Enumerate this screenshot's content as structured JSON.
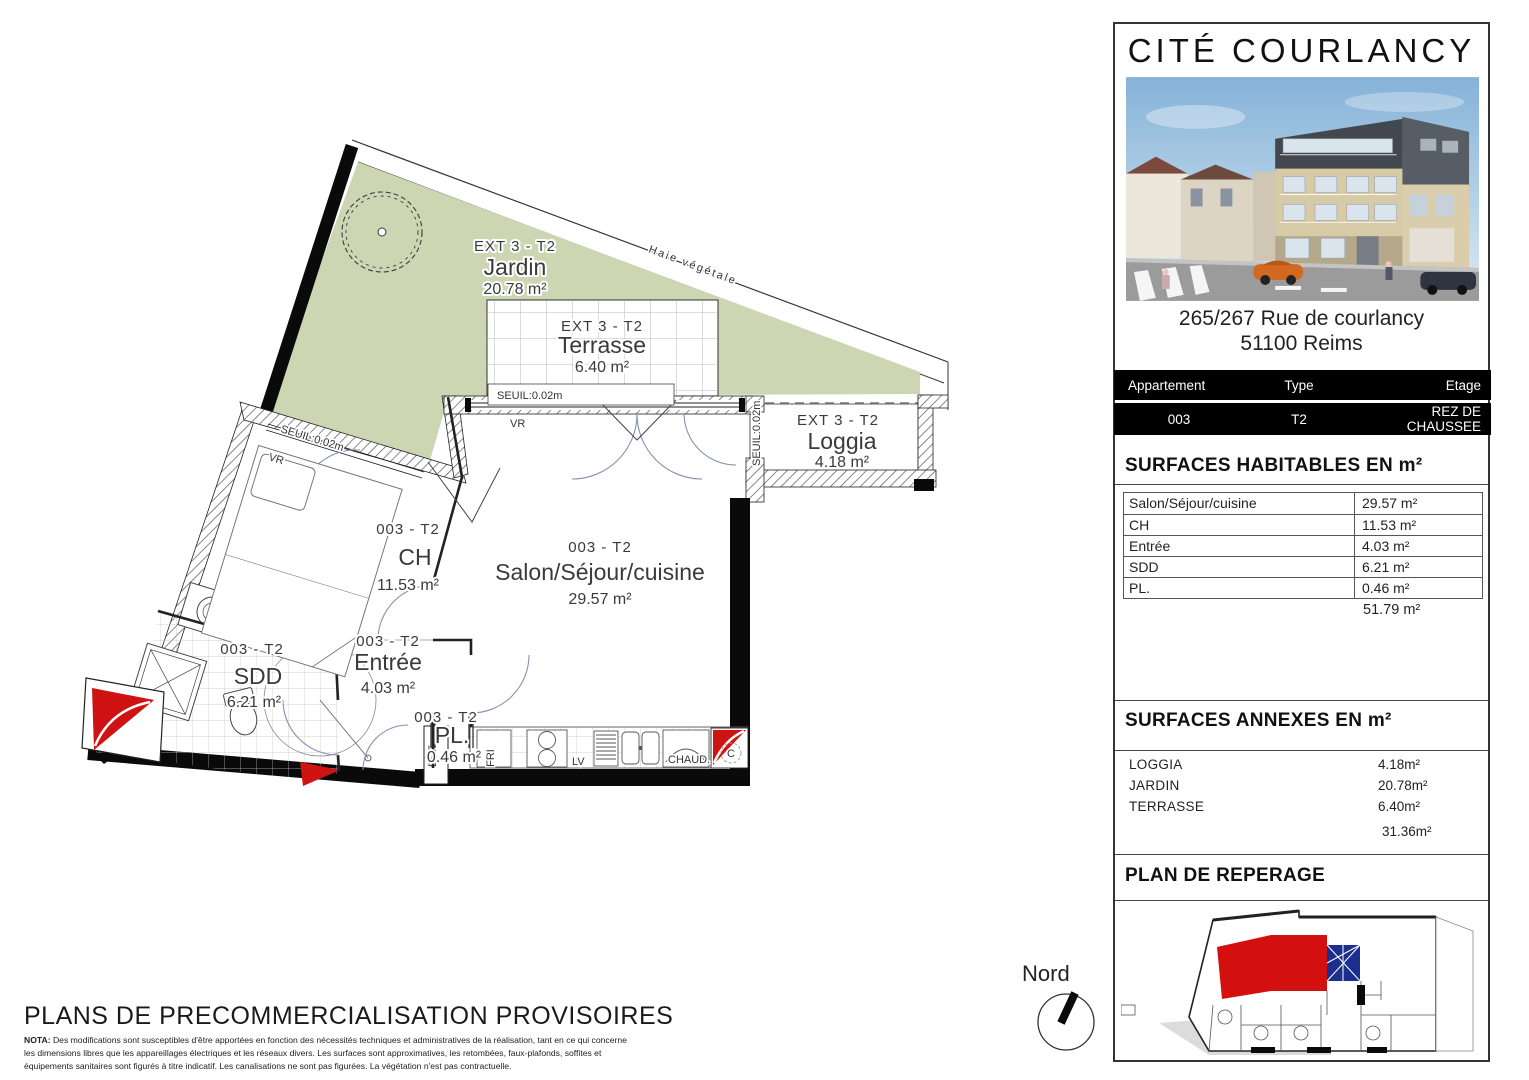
{
  "panel": {
    "title": "CITÉ COURLANCY",
    "address_line1": "265/267 Rue de courlancy",
    "address_line2": "51100 Reims",
    "info_table": {
      "col_appartement": "Appartement",
      "col_type": "Type",
      "col_etage": "Etage",
      "appartement": "003",
      "type": "T2",
      "etage": "REZ DE CHAUSSEE"
    },
    "habitables": {
      "title": "SURFACES HABITABLES EN m²",
      "rows": [
        {
          "label": "Salon/Séjour/cuisine",
          "value": "29.57 m²"
        },
        {
          "label": "CH",
          "value": "11.53 m²"
        },
        {
          "label": "Entrée",
          "value": "4.03 m²"
        },
        {
          "label": "SDD",
          "value": "6.21 m²"
        },
        {
          "label": "PL.",
          "value": "0.46 m²"
        }
      ],
      "total": "51.79 m²"
    },
    "annexes": {
      "title": "SURFACES ANNEXES EN m²",
      "rows": [
        {
          "label": "LOGGIA",
          "value": "4.18m²"
        },
        {
          "label": "JARDIN",
          "value": "20.78m²"
        },
        {
          "label": "TERRASSE",
          "value": "6.40m²"
        }
      ],
      "total": "31.36m²"
    },
    "reperage_title": "PLAN DE REPERAGE"
  },
  "plan": {
    "jardin": {
      "code": "EXT 3 - T2",
      "name": "Jardin",
      "area": "20.78 m²"
    },
    "terrasse": {
      "code": "EXT 3 - T2",
      "name": "Terrasse",
      "area": "6.40 m²"
    },
    "loggia": {
      "code": "EXT 3 - T2",
      "name": "Loggia",
      "area": "4.18 m²"
    },
    "salon": {
      "code": "003 - T2",
      "name": "Salon/Séjour/cuisine",
      "area": "29.57 m²"
    },
    "ch": {
      "code": "003 - T2",
      "name": "CH",
      "area": "11.53 m²"
    },
    "sdd": {
      "code": "003 - T2",
      "name": "SDD",
      "area": "6.21 m²"
    },
    "entree": {
      "code": "003 - T2",
      "name": "Entrée",
      "area": "4.03 m²"
    },
    "pl": {
      "code": "003 - T2",
      "name": "PL.",
      "area": "0.46 m²"
    },
    "hedge_label": "Haie végétale",
    "seuil_label": "SEUIL:0.02m",
    "vr_label": "VR",
    "edf_label": "EDF",
    "fri_label": "FRI",
    "lv_label": "LV",
    "chaud_label": "CHAUD.",
    "c_label": "C"
  },
  "compass_label": "Nord",
  "footer": {
    "title": "PLANS DE PRECOMMERCIALISATION PROVISOIRES",
    "nota_label": "NOTA:",
    "nota_text": "Des modifications sont susceptibles d'être apportées en fonction des nécessités techniques et administratives de la réalisation, tant en ce qui concerne les dimensions libres que les appareillages électriques et les réseaux divers. Les surfaces sont approximatives, les retombées, faux-plafonds, soffites et équipements sanitaires sont figurés à titre indicatif. Les canalisations ne sont pas figurées. La végétation n'est pas contractuelle."
  },
  "colors": {
    "garden_green": "#ccd6b3",
    "shaft_red": "#cf1212",
    "door_arc": "#8292b2"
  }
}
